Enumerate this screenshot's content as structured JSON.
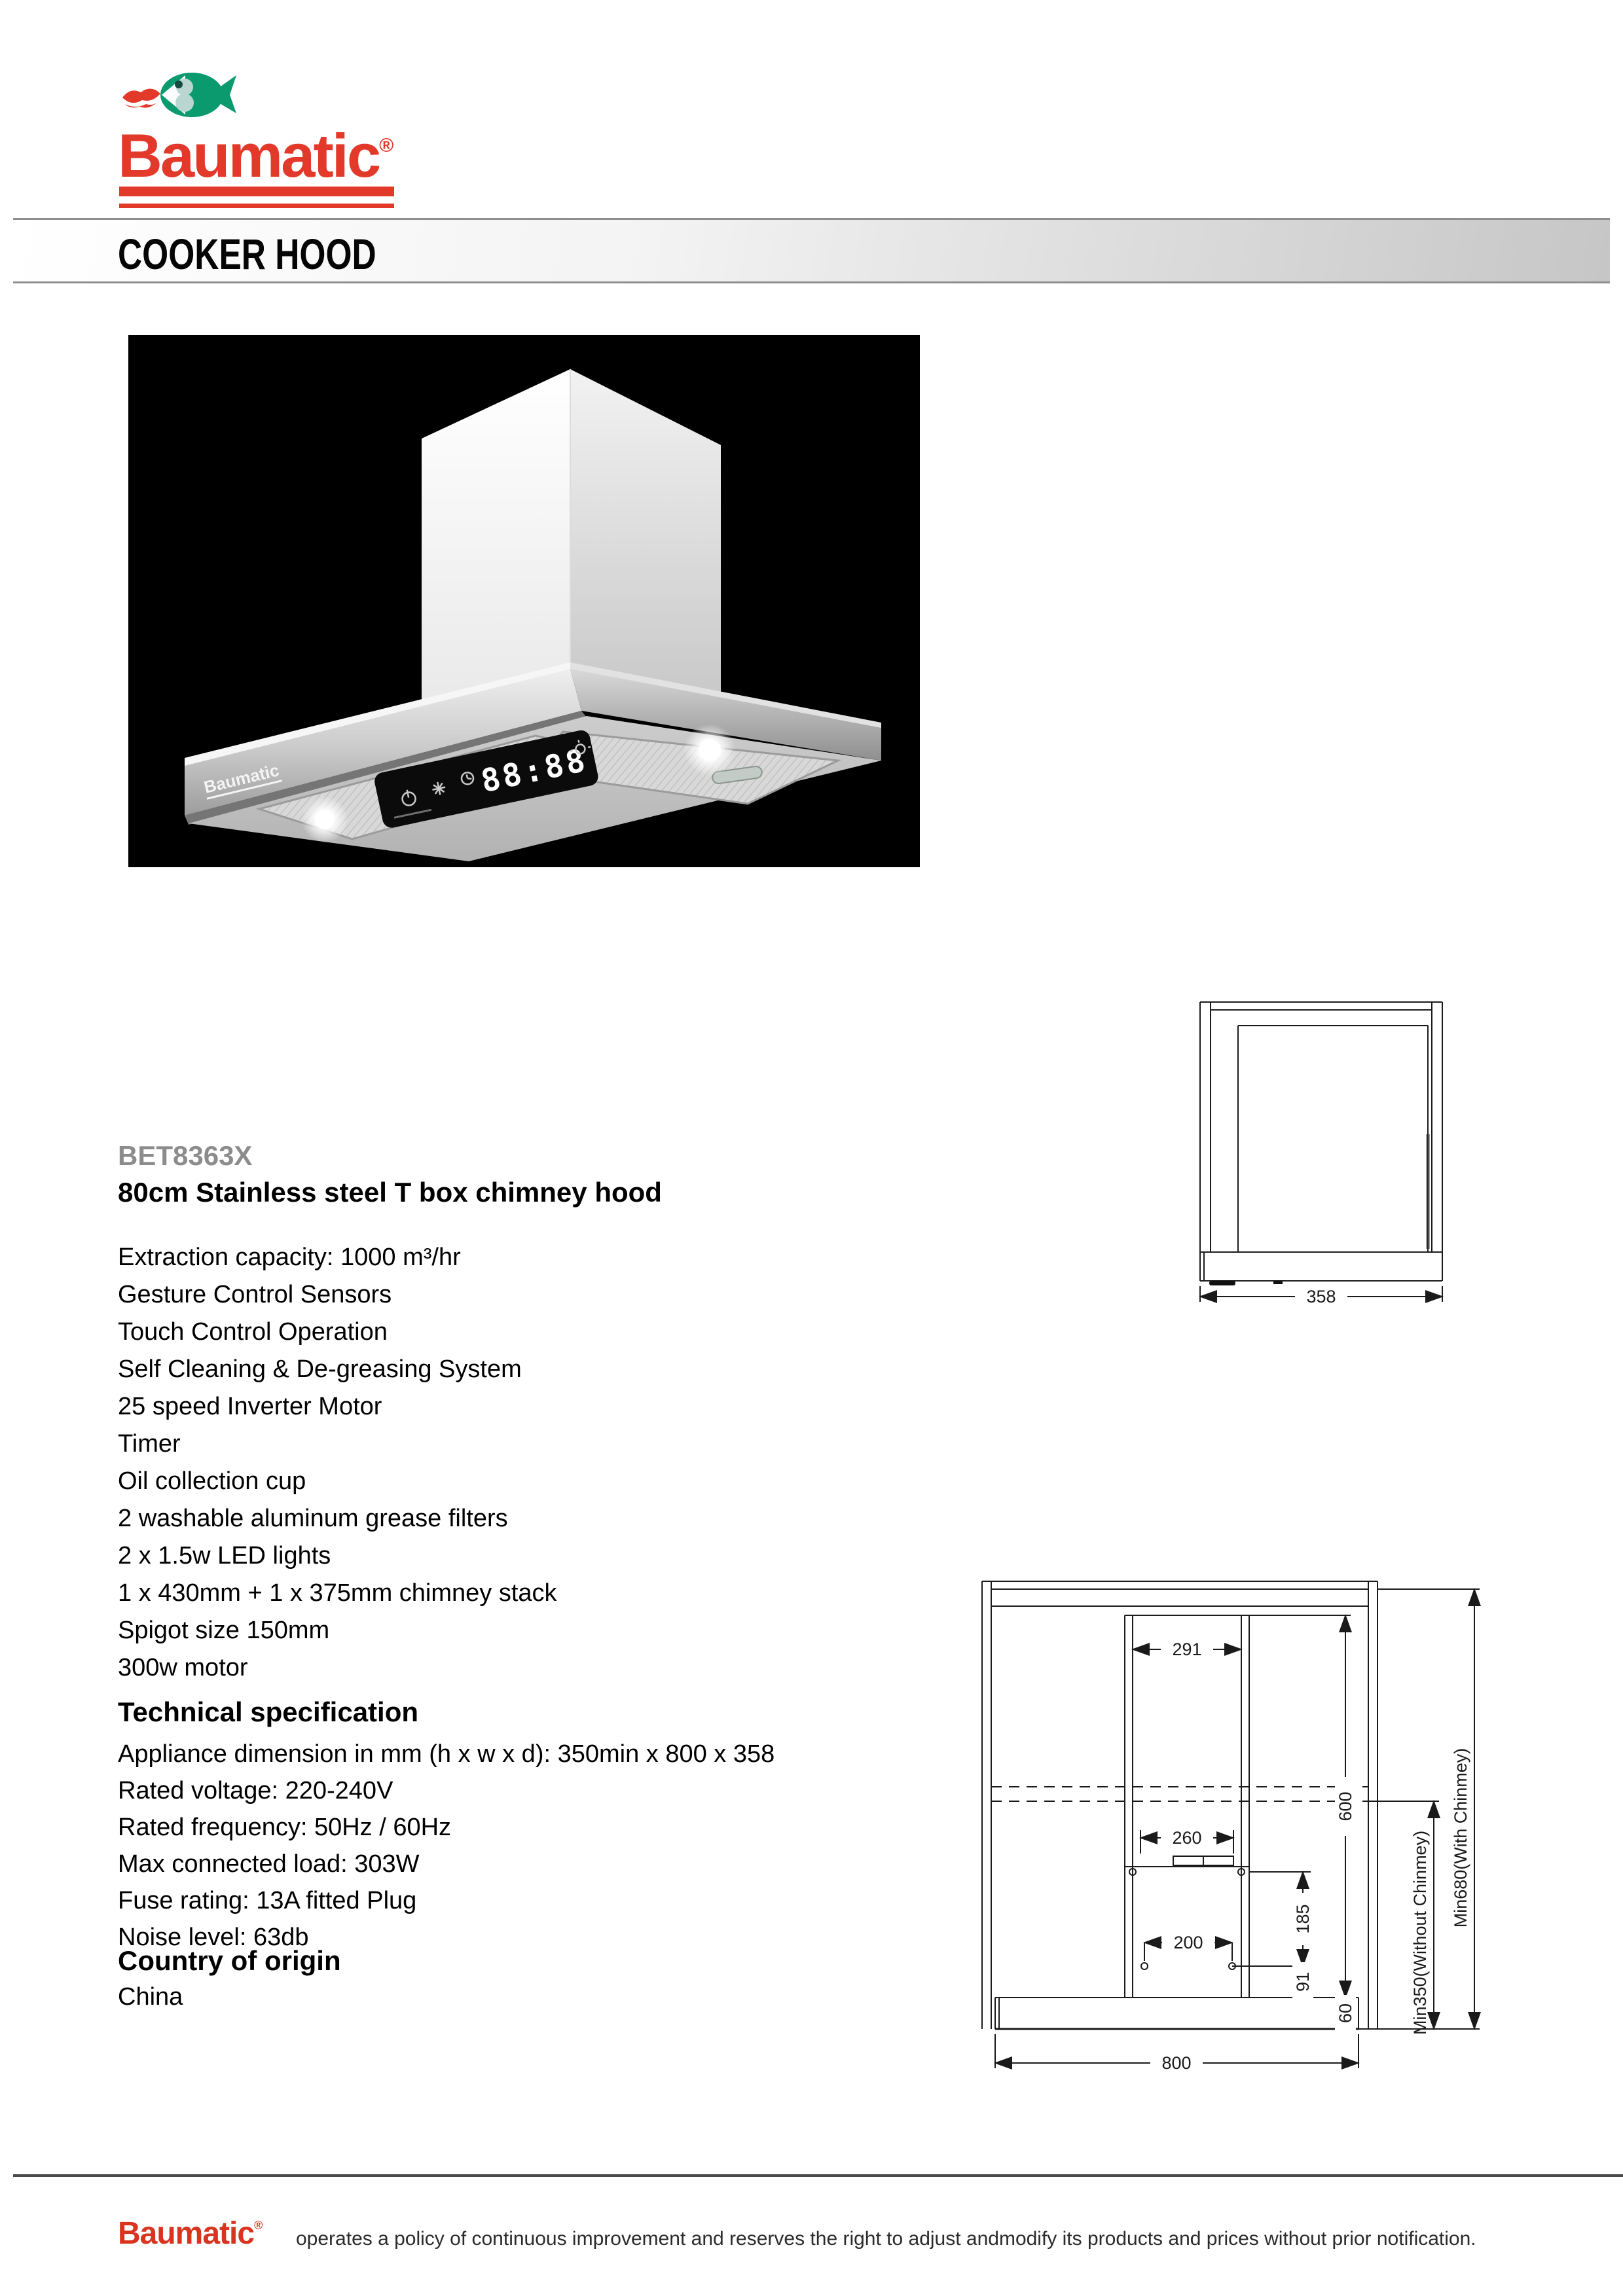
{
  "header": {
    "brand": "Baumatic",
    "trademark": "®",
    "section_title": "COOKER HOOD"
  },
  "product": {
    "model": "BET8363X",
    "name": "80cm Stainless steel T box chimney hood",
    "features": [
      "Extraction capacity: 1000 m³/hr",
      "Gesture Control Sensors",
      "Touch Control Operation",
      "Self Cleaning & De-greasing System",
      "25 speed Inverter Motor",
      "Timer",
      "Oil collection cup",
      "2 washable aluminum grease filters",
      "2 x 1.5w LED lights",
      "1 x 430mm + 1 x 375mm chimney stack",
      "Spigot size 150mm",
      "300w motor"
    ],
    "tech_heading": "Technical specification",
    "tech_specs": [
      "Appliance dimension in mm (h x w x d): 350min x 800 x 358",
      "Rated voltage: 220-240V",
      "Rated frequency: 50Hz / 60Hz",
      "Max connected load: 303W",
      "Fuse rating: 13A fitted Plug",
      "Noise level: 63db"
    ],
    "origin_heading": "Country of origin",
    "origin": "China"
  },
  "hood_image": {
    "display_value": "88:88",
    "badge": "Baumatic"
  },
  "diagrams": {
    "side_view": {
      "width": "358"
    },
    "front_view": {
      "chimney_width": "291",
      "spigot_width": "260",
      "holes_spacing": "200",
      "chimney_height": "600",
      "mount_height": "185",
      "hole_offset": "91",
      "body_height": "60",
      "total_width": "800",
      "min_without": "Min350(Without Chinmey)",
      "min_with": "Min680(With Chinmey)"
    }
  },
  "footer": {
    "brand": "Baumatic",
    "trademark": "®",
    "text": "operates a policy of continuous improvement and reserves the right to adjust andmodify its products and prices without prior notification."
  },
  "colors": {
    "brand_red": "#e2392a",
    "fish_green": "#0a9a6e",
    "model_gray": "#8c8c8c"
  }
}
